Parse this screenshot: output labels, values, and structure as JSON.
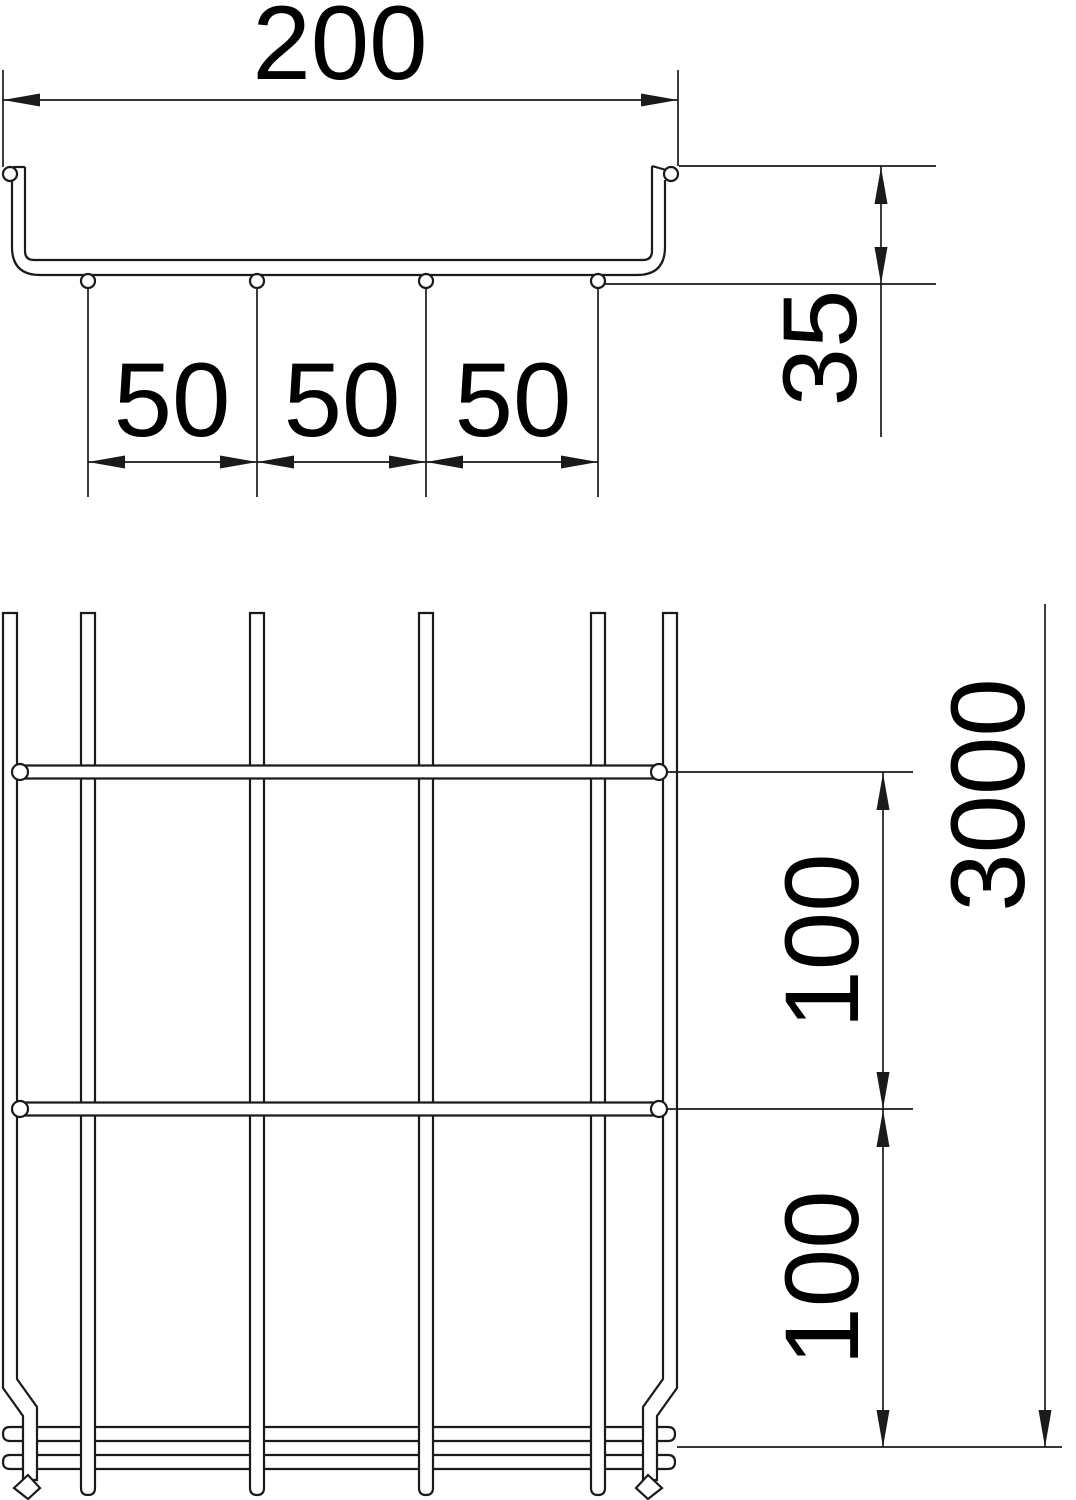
{
  "drawing_title": "Mesh cable tray dimensional drawing",
  "colors": {
    "line": "#1a1a1a",
    "background": "#ffffff"
  },
  "cross_section": {
    "width": "200",
    "height": "35",
    "wire_spacing": [
      "50",
      "50",
      "50"
    ]
  },
  "plan_view": {
    "length": "3000",
    "rung_pitch": [
      "100",
      "100"
    ]
  }
}
